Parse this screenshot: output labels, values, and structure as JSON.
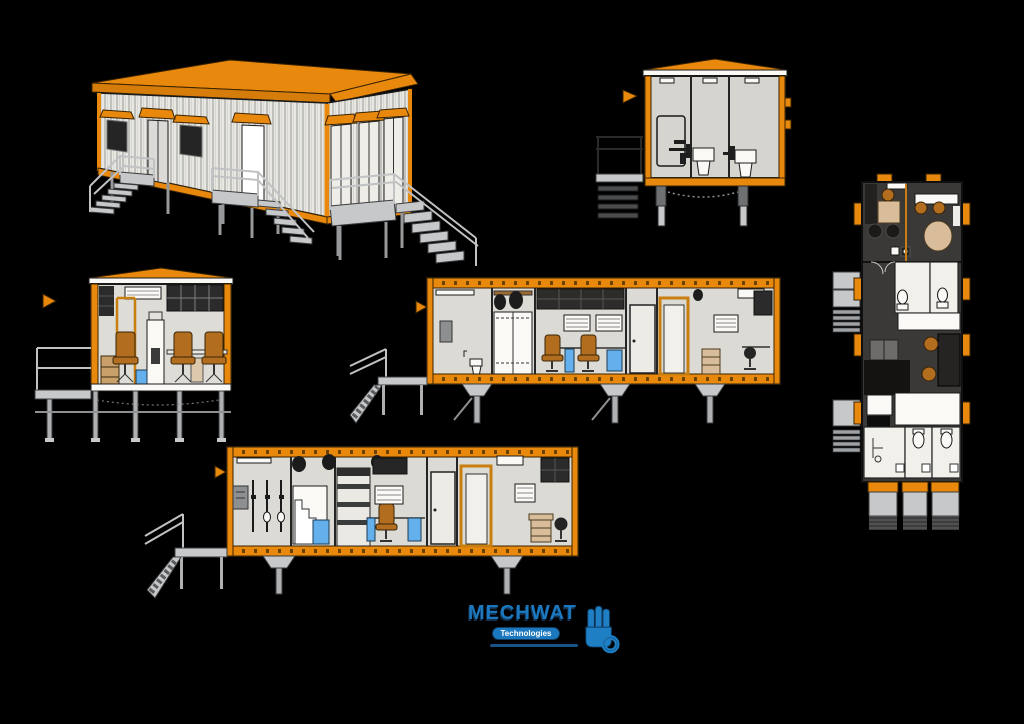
{
  "page": {
    "background": "#000000",
    "width": 1024,
    "height": 724
  },
  "logo": {
    "name": "MECHWAT",
    "subtitle": "Technologies"
  },
  "views": [
    {
      "name": "isometric-exterior-view"
    },
    {
      "name": "end-elevation-section"
    },
    {
      "name": "floor-plan-view"
    },
    {
      "name": "cross-section-office"
    },
    {
      "name": "long-section-upper"
    },
    {
      "name": "long-section-lower"
    }
  ],
  "colors": {
    "background": "#000000",
    "accent_orange": "#E8890D",
    "wall_light": "#E9E7E1",
    "interior_gray": "#DCDAD4",
    "dark_fitting": "#2B2B2B",
    "plan_floor_dark": "#3B3937",
    "steel_gray": "#C6C8CA",
    "chair_orange": "#B26E1E",
    "fixture_blue": "#64B0EC",
    "wood_tan": "#D9BD9B",
    "logo_blue": "#1C78BE",
    "logo_navy": "#123253"
  }
}
